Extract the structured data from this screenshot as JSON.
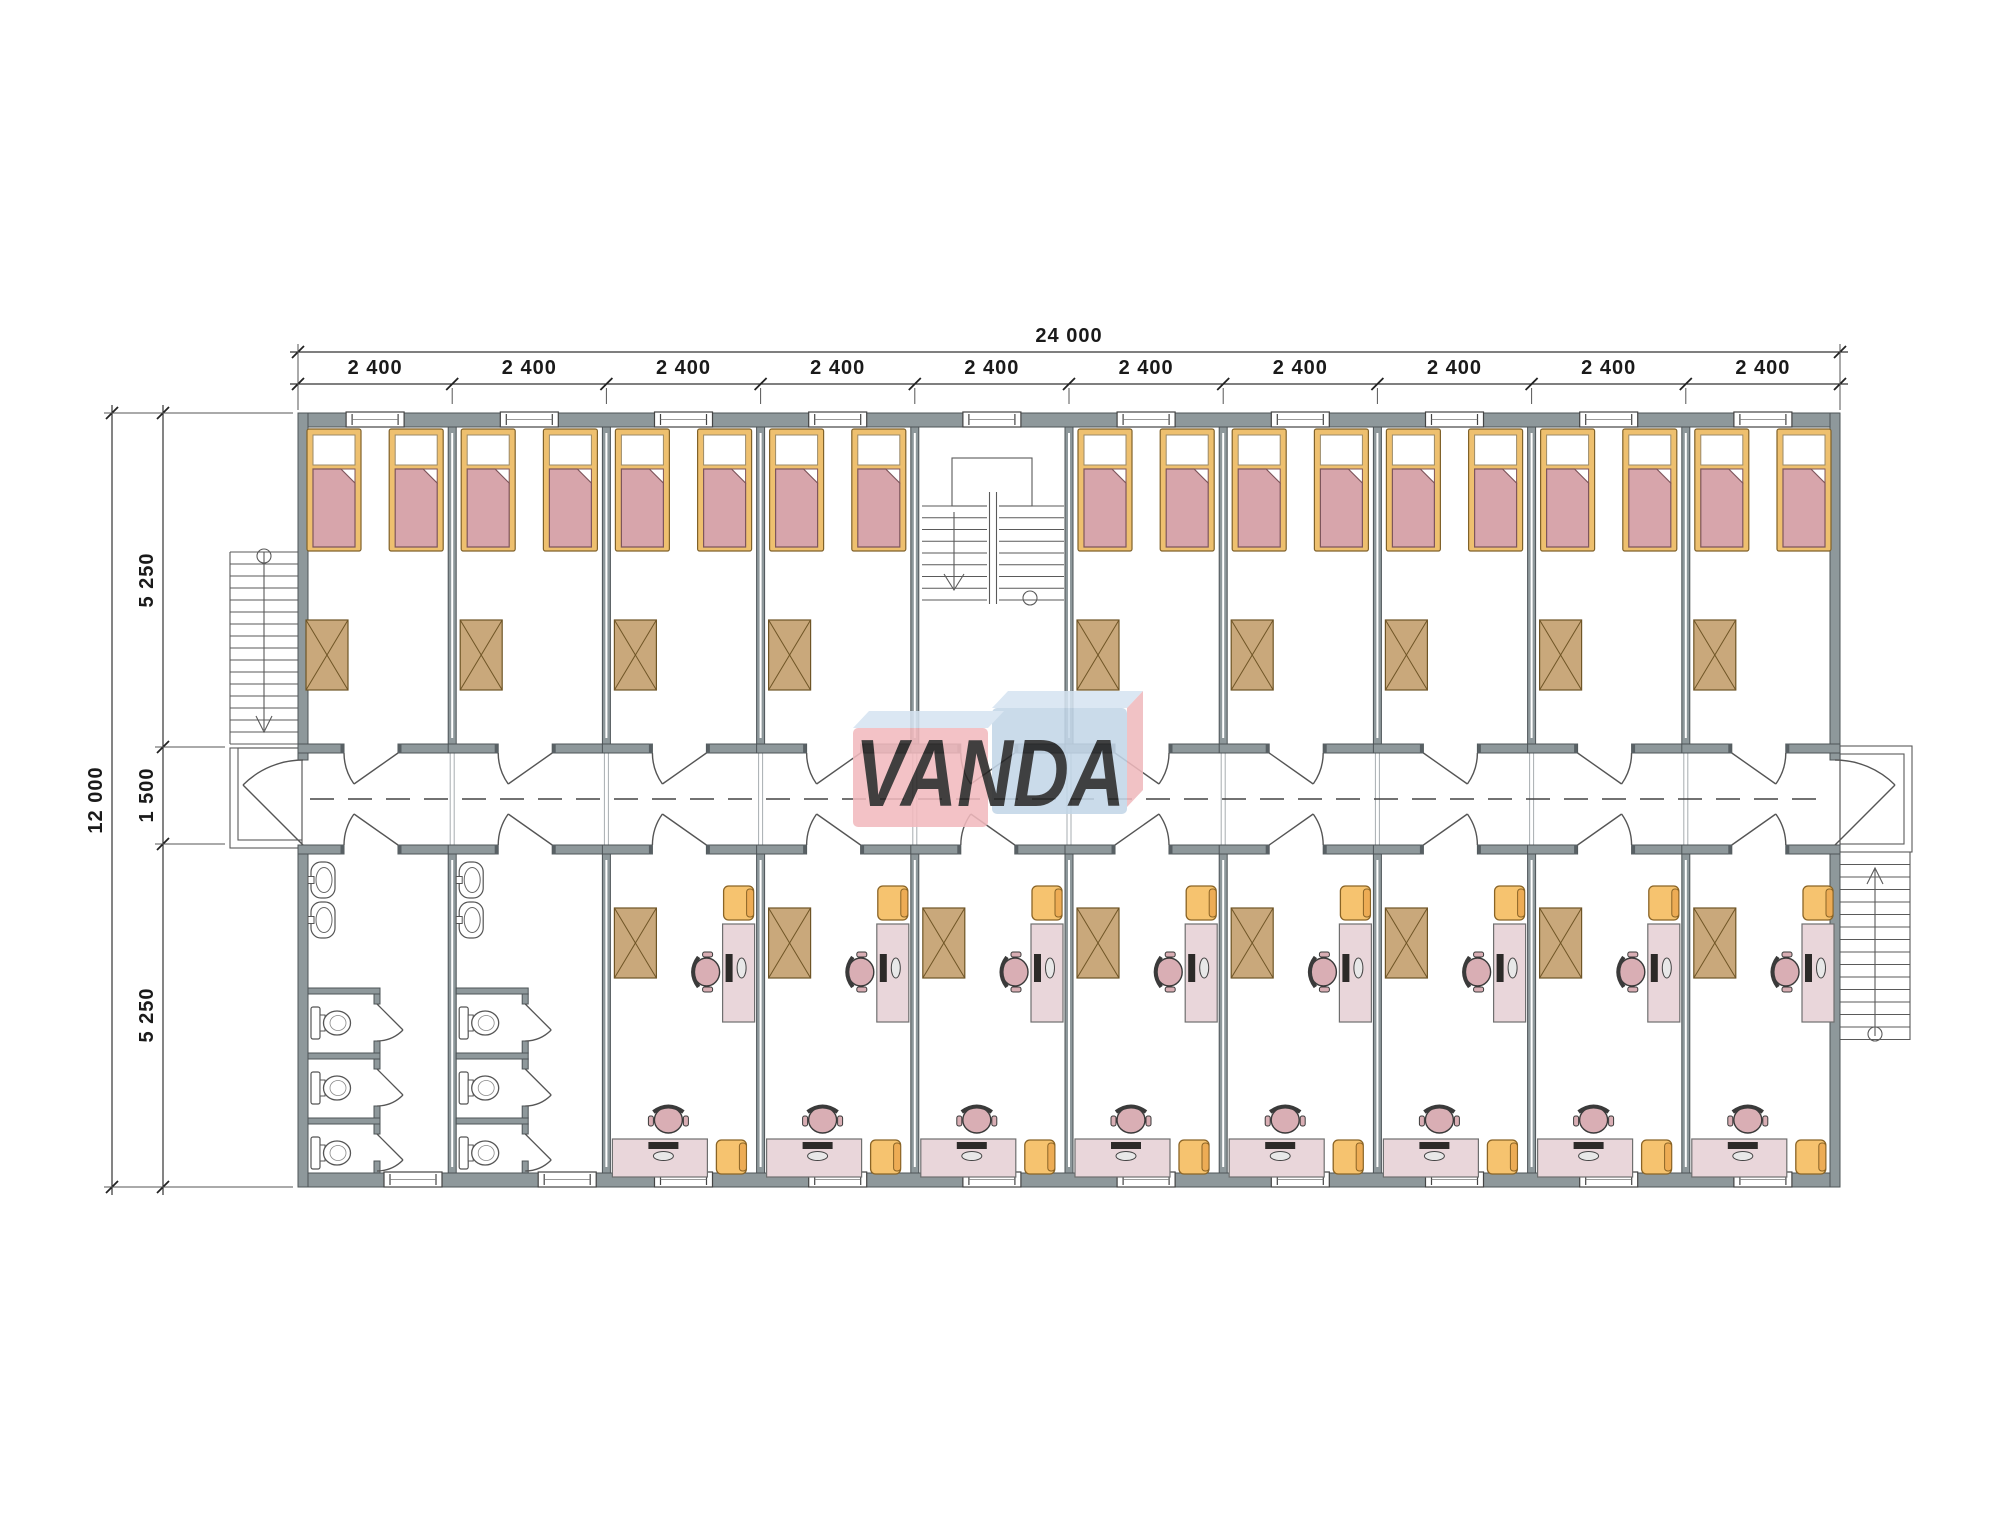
{
  "plan": {
    "logo": {
      "text": "VANDA",
      "pink": "#f2babe",
      "blue": "#c3d6e8",
      "top_face": "#d6e4f2",
      "side_face": "#f0b9bd",
      "text_color": "#ffffff"
    },
    "dims": {
      "total_width": "24 000",
      "top_segments": [
        "2 400",
        "2 400",
        "2 400",
        "2 400",
        "2 400",
        "2 400",
        "2 400",
        "2 400",
        "2 400",
        "2 400"
      ],
      "total_height": "12 000",
      "left_segments": [
        "5 250",
        "1 500",
        "5 250"
      ]
    },
    "building": {
      "bays": 10,
      "stair_bay_index": 5,
      "bathrooms": 2,
      "bedrooms_top": 9,
      "beds": 18,
      "study_rooms_bottom": 8,
      "desk_stations": 16,
      "toilets": 6,
      "sinks": 4,
      "wardrobes": 17,
      "windows": 20
    },
    "colors": {
      "wall": "#8e989b",
      "wall_outline": "#4d5457",
      "wall_cap": "#586064",
      "bed_frame": "#eec06f",
      "bed_frame_outline": "#80622a",
      "bed_blanket": "#d7a5ab",
      "bed_blanket_outline": "#7e565c",
      "pillow": "#ffffff",
      "wardrobe": "#c9a87b",
      "wardrobe_outline": "#6f5526",
      "desk": "#e9d6da",
      "desk_outline": "#6f6f6f",
      "monitor": "#2c2a28",
      "office_chair": "#d9aeb4",
      "office_chair_outline": "#3a3a3a",
      "side_chair": "#f6c36f",
      "side_chair_back": "#edac55",
      "side_chair_outline": "#8a6426",
      "fixture_outline": "#555555",
      "line": "#3f3f3f",
      "dim": "#1a1a1a"
    }
  }
}
